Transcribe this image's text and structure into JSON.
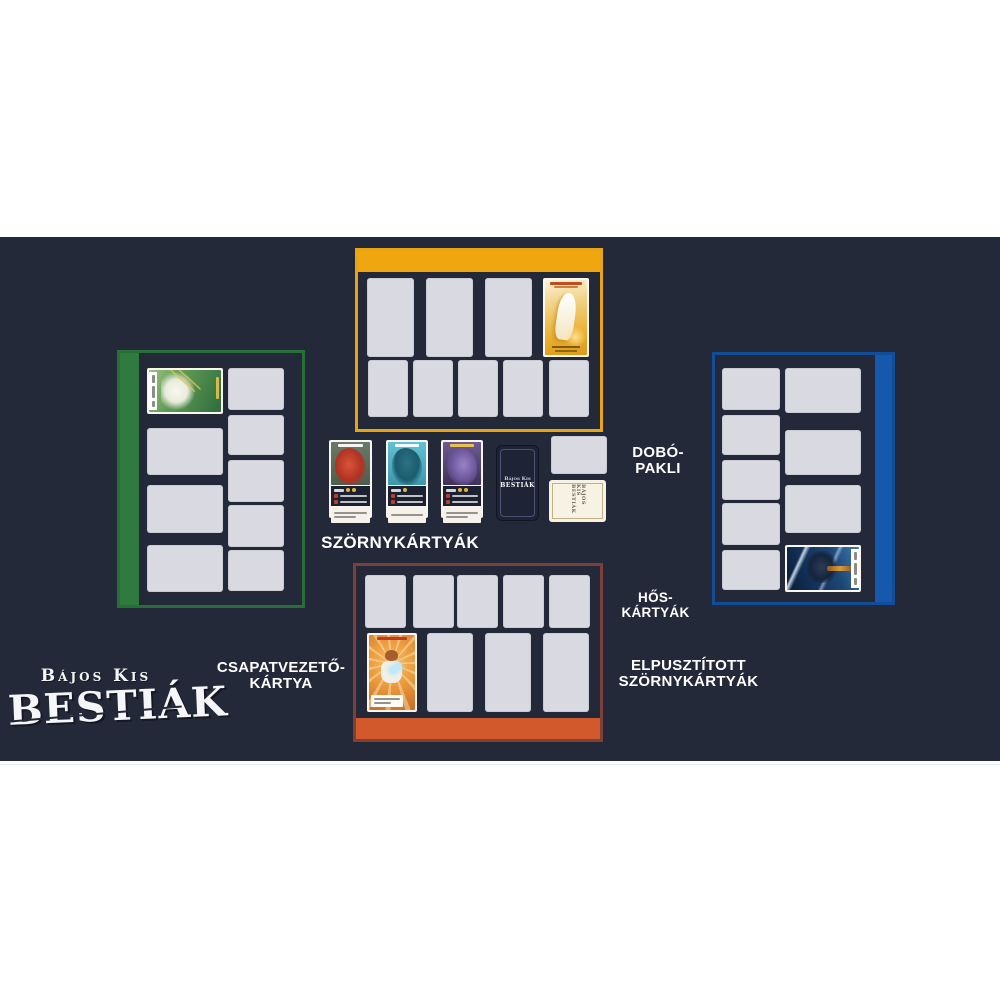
{
  "scene": {
    "background": "#ffffff",
    "mat_color": "#232939",
    "slot_color": "#D8D9E1"
  },
  "logo": {
    "top_line": "Bájos Kis",
    "main_line": "BESTIÁK",
    "full": "Bájos Kis Bestiák"
  },
  "labels": {
    "monster_cards": "SZÖRNYKÁRTYÁK",
    "discard_pile": [
      "DOBÓ-",
      "PAKLI"
    ],
    "hero_cards": [
      "HŐS-",
      "KÁRTYÁK"
    ],
    "team_leader_card": [
      "CSAPATVEZETŐ-",
      "KÁRTYA"
    ],
    "destroyed_monster_cards": [
      "ELPUSZTÍTOTT",
      "SZÖRNYKÁRTYÁK"
    ]
  },
  "players": {
    "top": {
      "color": "#EFA60F",
      "border_color": "#E8A511",
      "empty_hero_slots": 3,
      "empty_monster_slots": 5,
      "leader_card": "golden-lion-hero-card"
    },
    "left": {
      "color": "#2F7A3E",
      "border_color": "#2A6E37",
      "empty_hero_slots": 3,
      "empty_monster_slots": 5,
      "leader_card": "green-forest-dragon-hero-card"
    },
    "right": {
      "color": "#1659AC",
      "border_color": "#124E97",
      "empty_hero_slots": 3,
      "empty_monster_slots": 5,
      "leader_card": "blue-ice-knight-hero-card"
    },
    "bottom": {
      "color": "#D2592B",
      "border_color": "#7D4038",
      "empty_hero_slots": 3,
      "empty_monster_slots": 5,
      "leader_card": "orange-cat-bard-hero-card"
    }
  },
  "center_row": {
    "face_up_monster_cards": [
      {
        "name": "red-dragon-monster-card",
        "art_color": "#c23b2a",
        "coin_count": 2
      },
      {
        "name": "teal-shark-monster-card",
        "art_color": "#3d98ad",
        "coin_count": 1
      },
      {
        "name": "purple-dragon-monster-card",
        "art_color": "#9a83c4",
        "coin_count": 2
      }
    ],
    "monster_deck_card_back": true,
    "discard_slot_empty": true,
    "white_card_back": true
  }
}
